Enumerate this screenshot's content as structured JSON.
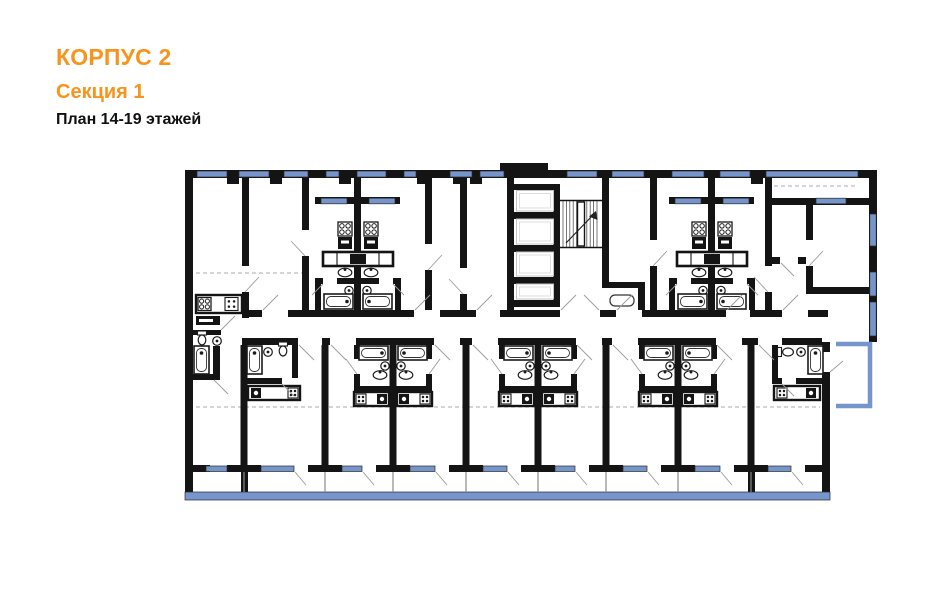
{
  "header": {
    "building": "КОРПУС 2",
    "section": "Секция 1",
    "floors": "План 14-19 этажей"
  },
  "colors": {
    "accent": "#F7941D",
    "text": "#111111",
    "background": "#FFFFFF",
    "wall": "#141414",
    "window_blue": "#7595CB",
    "window_outline": "#2A2A2A",
    "fixture_line": "#1A1A1A",
    "door_swing": "#9A9A9A",
    "dashed_guide": "#ABABAB",
    "shaft_outline": "#C4C4C4"
  }
}
